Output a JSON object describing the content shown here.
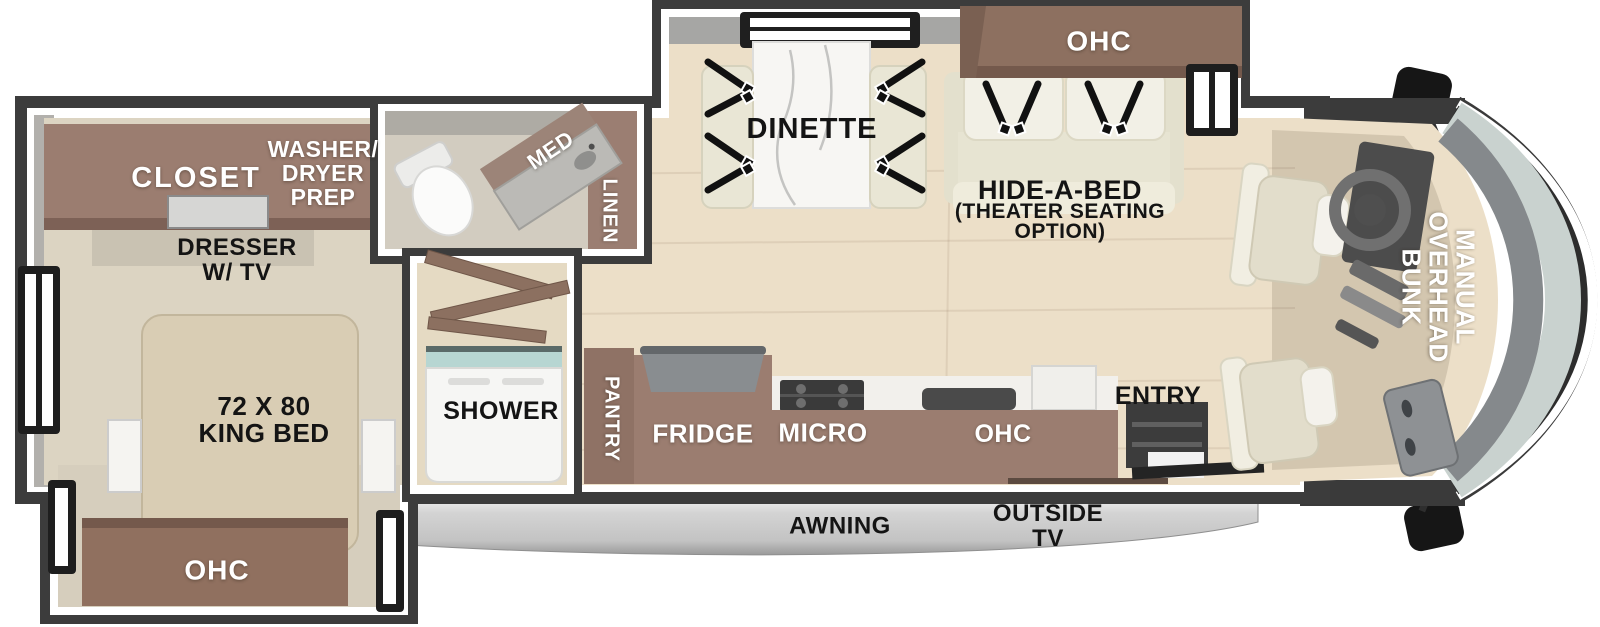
{
  "floorplan": {
    "type": "RV motorhome floor plan, top-down view",
    "bedroom": {
      "closet": "CLOSET",
      "washer_dryer_prep": [
        "WASHER/",
        "DRYER",
        "PREP"
      ],
      "dresser": [
        "DRESSER",
        "W/ TV"
      ],
      "bed": [
        "72 X 80",
        "KING BED"
      ],
      "overhead_cabinet": "OHC"
    },
    "bathroom": {
      "medicine_cabinet": "MED",
      "linen": "LINEN",
      "shower": "SHOWER"
    },
    "kitchen": {
      "pantry": "PANTRY",
      "fridge": "FRIDGE",
      "microwave": "MICRO",
      "overhead_cabinet": "OHC",
      "entry": "ENTRY"
    },
    "living": {
      "dinette": "DINETTE",
      "sofa_overhead_cabinet": "OHC",
      "hide_a_bed": [
        "HIDE-A-BED",
        "(THEATER SEATING",
        "OPTION)"
      ]
    },
    "cab": {
      "overhead_bunk": [
        "MANUAL",
        "OVERHEAD",
        "BUNK"
      ]
    },
    "exterior": {
      "awning": "AWNING",
      "outside_tv": [
        "OUTSIDE",
        "TV"
      ]
    },
    "colors": {
      "wall": "#3c3c3c",
      "wall_face": "#b2b0ac",
      "wood_floor": "#ecdfc8",
      "bedroom_floor": "#dcd4c2",
      "cabinet_brown": "#9b7d70",
      "cabinet_brown_dark": "#7d6156",
      "cushion_cream": "#e9e6d5",
      "cushion_white": "#f2f0e6",
      "bed_tan": "#d9cdb4",
      "marble_white": "#f7f6f3",
      "glass_teal": "#c9d2cf",
      "awning_gray": "#c9c9c9",
      "seatbelt_black": "#111111"
    }
  }
}
